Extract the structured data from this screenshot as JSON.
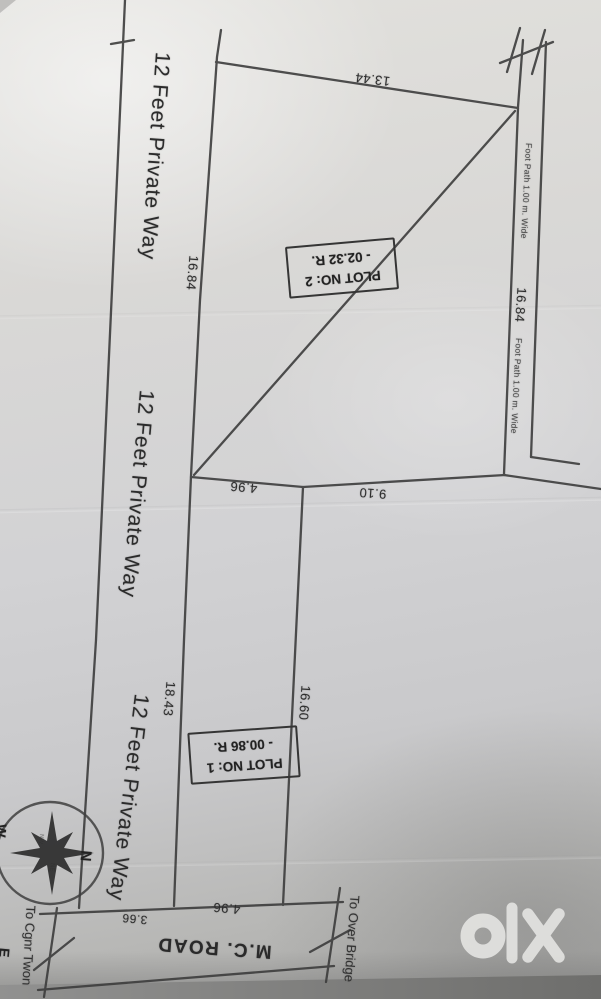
{
  "private_way": {
    "label_1": "12 Feet Private Way",
    "label_2": "12 Feet Private Way",
    "label_3": "12 Feet Private Way"
  },
  "plot2": {
    "title": "PLOT NO: 2",
    "area": "- 02.32 R."
  },
  "plot1": {
    "title": "PLOT NO: 1",
    "area": "- 00.86 R."
  },
  "measurements": {
    "plot2_top": "13.44",
    "plot2_west_side": "16.84",
    "plot2_east_side": "16.84",
    "mid_left": "4.96",
    "mid_right": "9.10",
    "plot1_west_side": "18.43",
    "plot1_east_side": "16.60",
    "road_frontage": "4.96",
    "way_width_at_road": "3.66"
  },
  "footpath": {
    "label_upper": "Foot Path 1.00 m. Wide",
    "label_lower": "Foot Path 1.00 m. Wide"
  },
  "road": {
    "name": "M.C. ROAD",
    "left_destination": "To Cgnr Twon",
    "right_destination": "To Over Bridge"
  },
  "compass": {
    "north": "N",
    "west": "W",
    "east": "E",
    "nw": "NW",
    "ne": "NE"
  },
  "watermark": {
    "brand": "olx"
  },
  "colors": {
    "paper": "#d6d6d4",
    "ink": "#3a3a3a",
    "watermark": "#e6e6e4"
  }
}
